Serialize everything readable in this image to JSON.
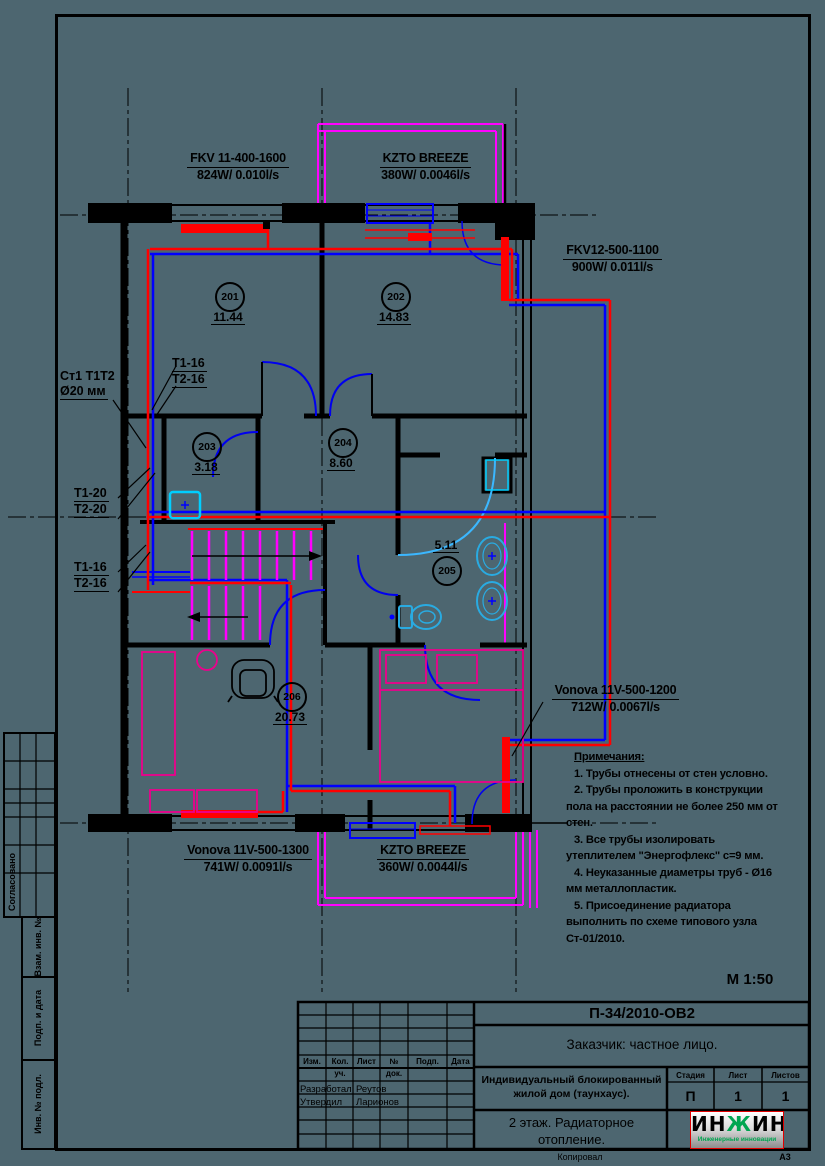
{
  "colors": {
    "background": "#4d6670",
    "supply_pipe": "#ff0000",
    "return_pipe": "#0000ff",
    "railing_stairs": "#ff00ff",
    "fixtures": "#29abe2",
    "furniture": "#ec008c",
    "logo_green": "#00a651"
  },
  "drawing": {
    "scale_label": "М 1:50",
    "equipment_labels": {
      "fkv11": {
        "name": "FKV 11-400-1600",
        "spec": "824W/ 0.010l/s"
      },
      "kzto_top": {
        "name": "KZTO BREEZE",
        "spec": "380W/ 0.0046l/s"
      },
      "fkv12": {
        "name": "FKV12-500-1100",
        "spec": "900W/ 0.011l/s"
      },
      "vonova_right": {
        "name": "Vonova 11V-500-1200",
        "spec": "712W/ 0.0067l/s"
      },
      "vonova_bottom": {
        "name": "Vonova 11V-500-1300",
        "spec": "741W/ 0.0091l/s"
      },
      "kzto_bottom": {
        "name": "KZTO BREEZE",
        "spec": "360W/ 0.0044l/s"
      }
    },
    "pipe_labels": {
      "riser": {
        "line1": "Ст1 Т1Т2",
        "line2": "Ø20 мм"
      },
      "t16_top": {
        "line1": "Т1-16",
        "line2": "Т2-16"
      },
      "t20": {
        "line1": "Т1-20",
        "line2": "Т2-20"
      },
      "t16_bottom": {
        "line1": "Т1-16",
        "line2": "Т2-16"
      }
    },
    "rooms": [
      {
        "num": "201",
        "area": "11.44"
      },
      {
        "num": "202",
        "area": "14.83"
      },
      {
        "num": "203",
        "area": "3.18"
      },
      {
        "num": "204",
        "area": "8.60"
      },
      {
        "num": "205",
        "area": "5.11"
      },
      {
        "num": "206",
        "area": "20.73"
      }
    ],
    "notes": {
      "title": "Примечания:",
      "lines": [
        "1. Трубы отнесены от стен условно.",
        "2. Трубы проложить в конструкции",
        "пола на расстоянии не более 250 мм от",
        "стен.",
        "3. Все трубы изолировать",
        "утеплителем \"Энергофлекс\" с=9 мм.",
        "4. Неуказанные диаметры труб - Ø16",
        "мм металлопластик.",
        "5. Присоединение радиатора",
        "выполнить по схеме типового узла",
        "Ст-01/2010."
      ]
    }
  },
  "margin_stamp": {
    "approved": "Согласовано",
    "vzam": "Взам. инв. №",
    "podp": "Подп. и дата",
    "inv": "Инв. № подл."
  },
  "titleblock": {
    "doc_code": "П-34/2010-ОВ2",
    "client": "Заказчик: частное лицо.",
    "columns": {
      "izm": "Изм.",
      "kol": "Кол. уч.",
      "list": "Лист",
      "ndok": "№ док.",
      "podp": "Подп.",
      "data": "Дата"
    },
    "roles": [
      {
        "role": "Разработал",
        "name": "Реутов"
      },
      {
        "role": "Утвердил",
        "name": "Ларионов"
      }
    ],
    "object": "Индивидуальный блокированный жилой дом (таунхаус).",
    "stage_label": "Стадия",
    "sheet_label": "Лист",
    "sheets_label": "Листов",
    "stage": "П",
    "sheet": "1",
    "sheets": "1",
    "sheet_title": "2 этаж.  Радиаторное отопление.",
    "logo": {
      "part1": "ИН",
      "part2": "Ж",
      "part3": "ИН",
      "subtitle": "Инженерные инновации"
    },
    "footer_copy": "Копировал",
    "footer_format": "А3"
  }
}
